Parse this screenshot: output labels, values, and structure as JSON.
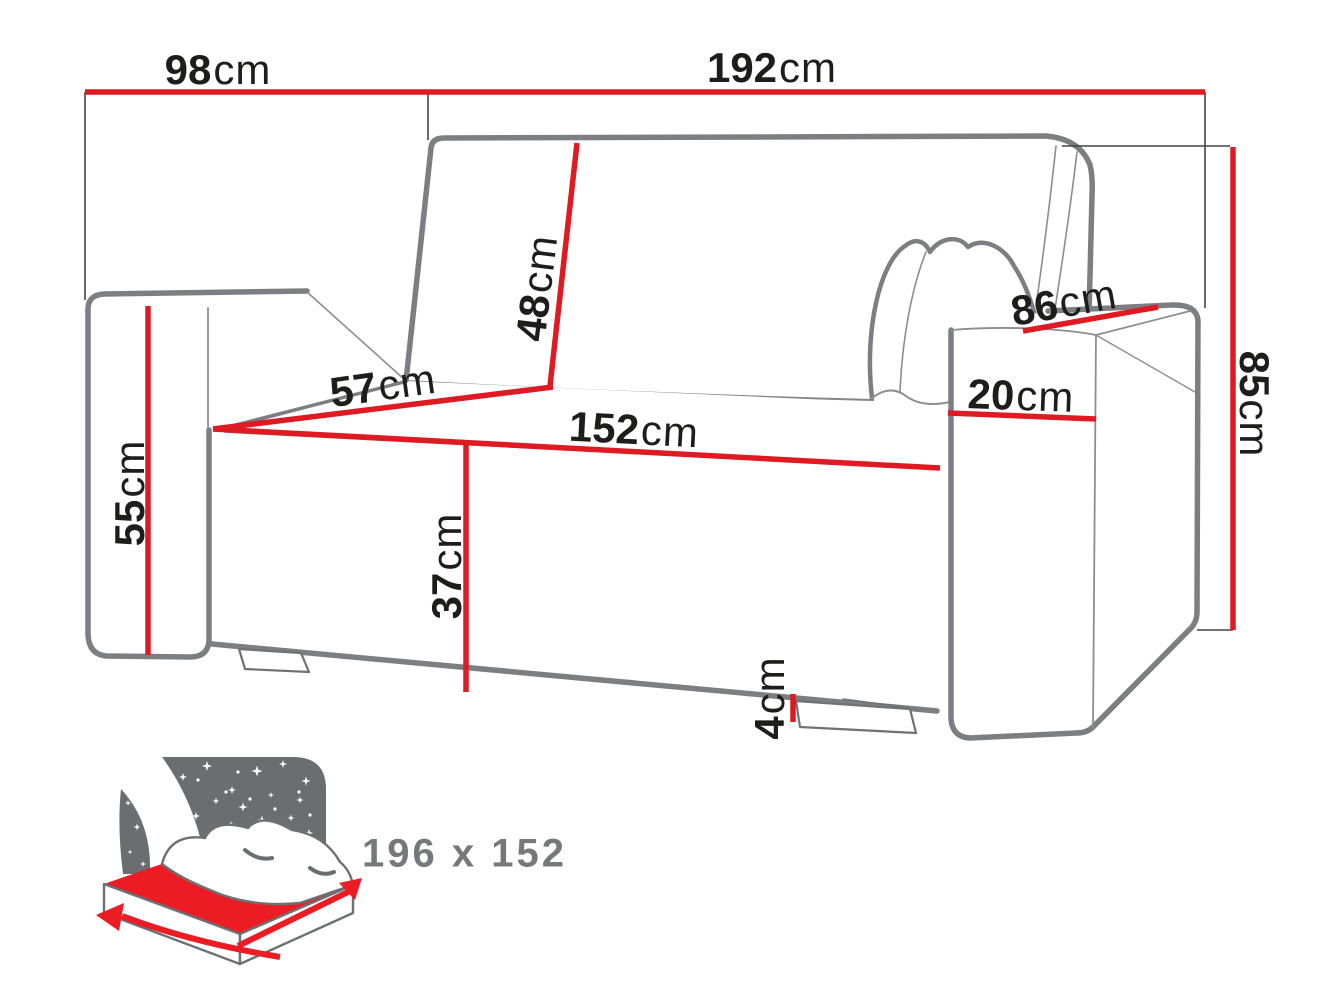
{
  "diagram": {
    "type": "furniture-dimension-diagram",
    "subject": "sofa-bed with two armrests, back pillow and fold-out sleeping surface",
    "dimensions": {
      "depth": {
        "value": "98",
        "unit": "cm"
      },
      "total_width": {
        "value": "192",
        "unit": "cm"
      },
      "backrest_height": {
        "value": "48",
        "unit": "cm"
      },
      "armrest_front_height": {
        "value": "55",
        "unit": "cm"
      },
      "seat_depth": {
        "value": "57",
        "unit": "cm"
      },
      "seat_width": {
        "value": "152",
        "unit": "cm"
      },
      "seat_height": {
        "value": "37",
        "unit": "cm"
      },
      "clearance_height": {
        "value": "4",
        "unit": "cm"
      },
      "armrest_depth": {
        "value": "86",
        "unit": "cm"
      },
      "armrest_width": {
        "value": "20",
        "unit": "cm"
      },
      "total_height": {
        "value": "85",
        "unit": "cm"
      }
    },
    "sleeping_area": {
      "icon": "bed-under-starry-sky-icon",
      "size_label": "196 x 152"
    },
    "colors": {
      "dimension_line_red": "#de1a22",
      "sofa_outline_gray": "#7c7e81",
      "label_black": "#1d1d1b",
      "icon_sky_gray": "#6a6e71",
      "icon_mattress_red": "#ec1c24",
      "icon_text_gray": "#77787b"
    }
  }
}
